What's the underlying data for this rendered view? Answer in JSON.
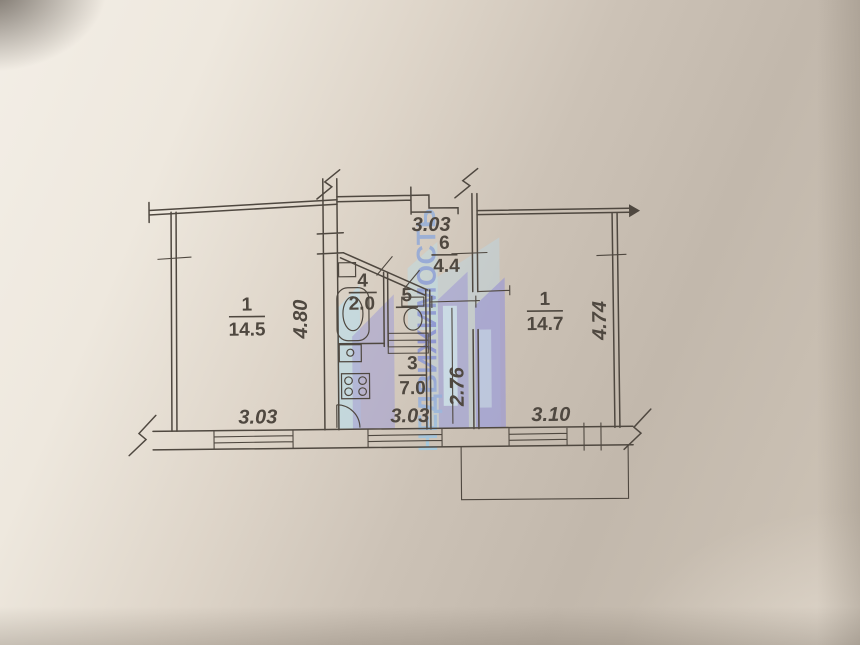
{
  "colors": {
    "ink": "#4f4840",
    "paper": "#cfc5b8",
    "wm-periwinkle": "#9f9bd6",
    "wm-lightblue": "#b9e0ee",
    "wm-text-blue": "#7f88d6",
    "wm-text-cyan": "#9ecfe8"
  },
  "floor_plan": {
    "rooms": {
      "left": {
        "number": "1",
        "area": "14.5"
      },
      "right": {
        "number": "1",
        "area": "14.7"
      },
      "kitchen": {
        "number": "3",
        "area": "7.0"
      },
      "bathroom": {
        "number": "4",
        "area": "2.0"
      },
      "toilet": {
        "number": "5"
      },
      "hallway": {
        "number": "6",
        "area": "4.4"
      }
    },
    "dimensions": {
      "top": "3.03",
      "left_vertical": "4.80",
      "right_vertical": "4.74",
      "middle_vertical": "2.76",
      "bottom_left": "3.03",
      "bottom_center": "3.03",
      "bottom_right": "3.10"
    },
    "watermark": {
      "text": "НЕДВИЖИМОСТЬ"
    }
  }
}
